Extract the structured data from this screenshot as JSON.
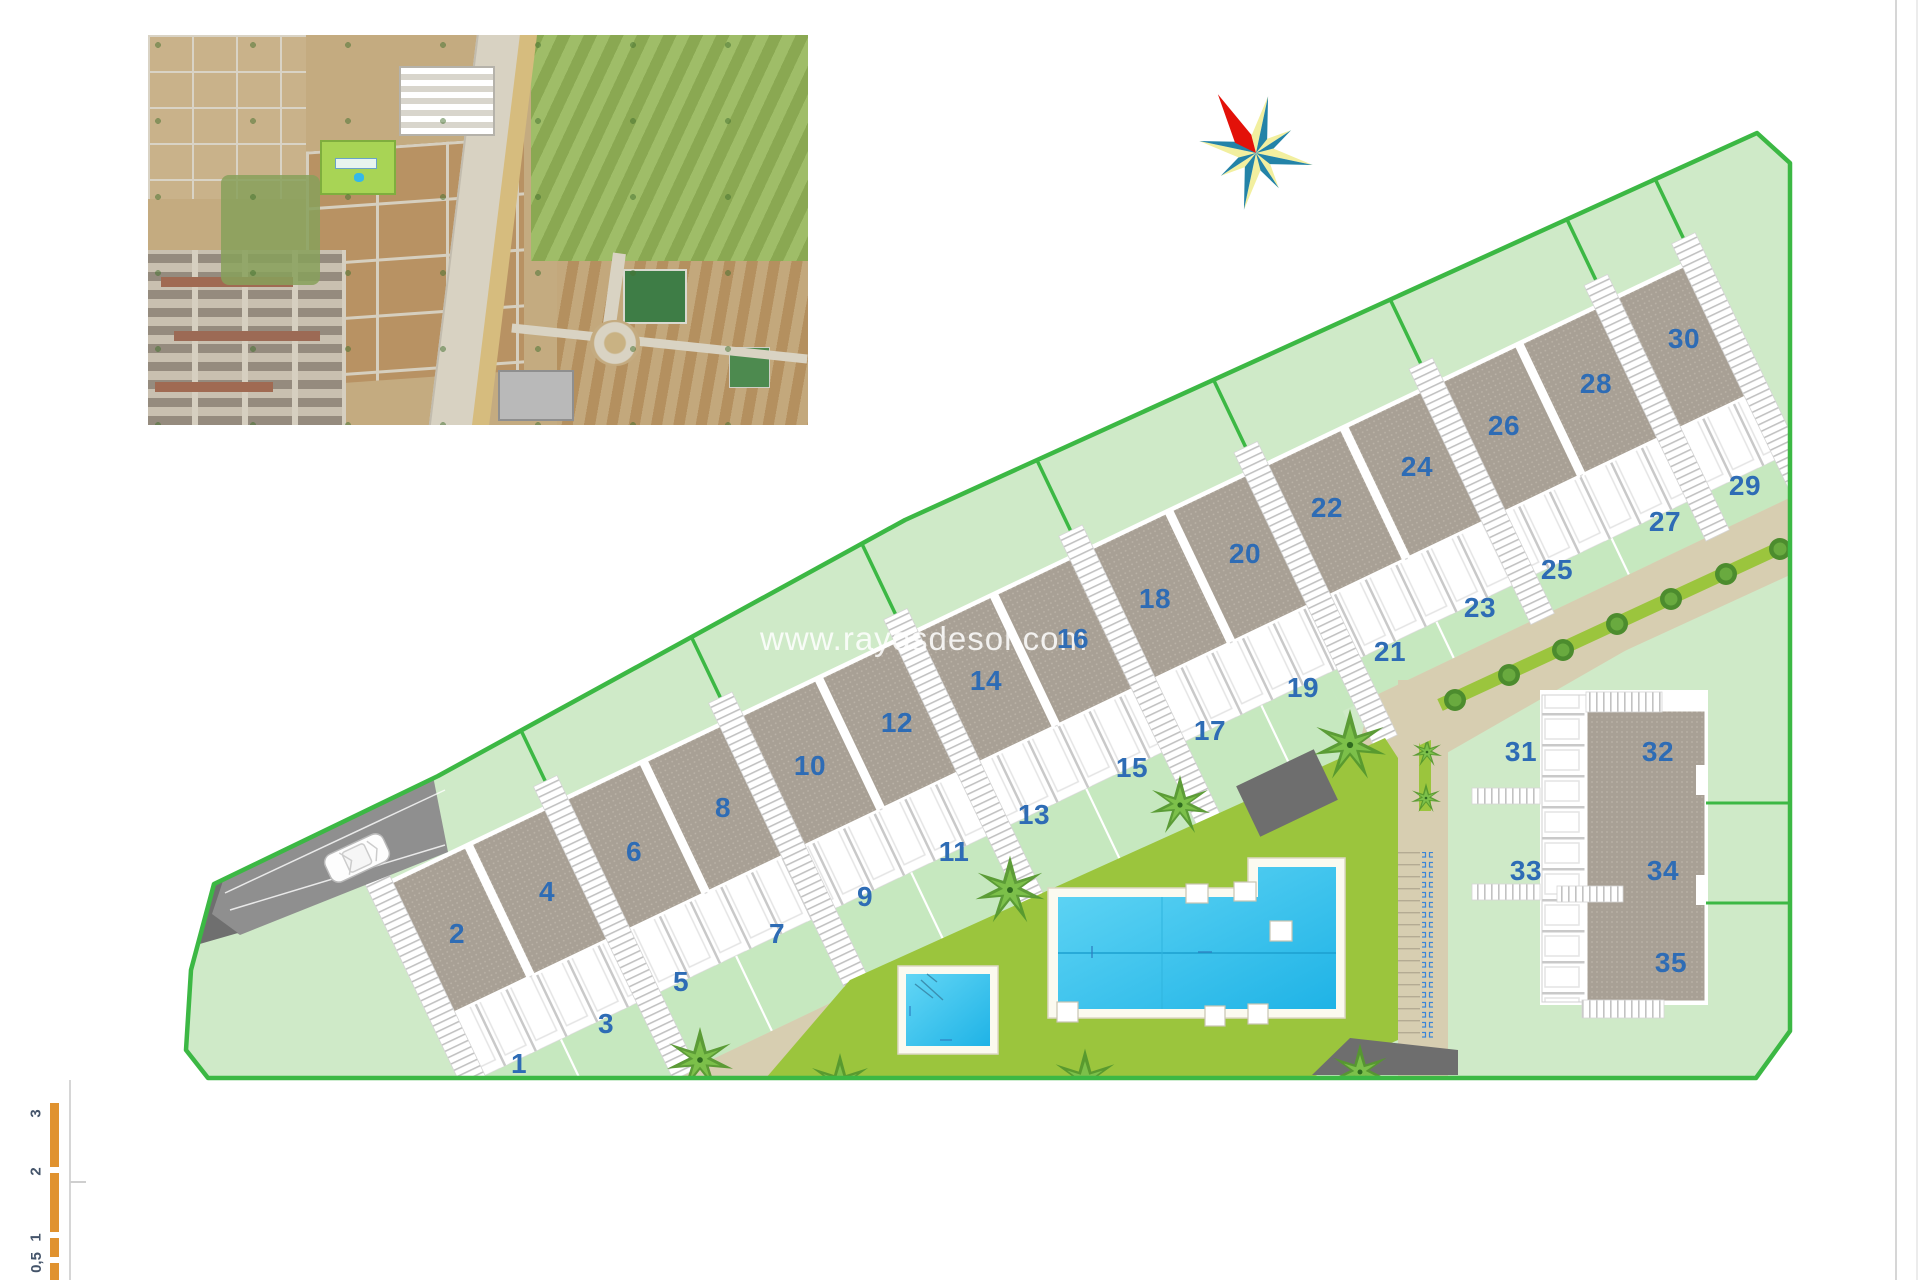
{
  "watermark": {
    "text": "www.rayosdesol.com"
  },
  "plots": {
    "labels": [
      "1",
      "2",
      "3",
      "4",
      "5",
      "6",
      "7",
      "8",
      "9",
      "10",
      "11",
      "12",
      "13",
      "14",
      "15",
      "16",
      "17",
      "18",
      "19",
      "20",
      "21",
      "22",
      "23",
      "24",
      "25",
      "26",
      "27",
      "28",
      "29",
      "30",
      "31",
      "32",
      "33",
      "34",
      "35"
    ]
  },
  "scale_bar": {
    "labels": [
      "3",
      "2",
      "1",
      "0,5"
    ]
  },
  "icons": {
    "compass": "compass-rose",
    "car": "car-top-view",
    "palm": "palm-tree",
    "street_tree": "street-tree"
  },
  "colors": {
    "parcel_green": "#cfeac8",
    "boundary_green": "#3cb844",
    "lawn_olive": "#9bc53d",
    "road_beige": "#d7ceb1",
    "roof_gray": "#a8a095",
    "pool_cyan": "#35c4ef",
    "plot_number_blue": "#2e6cb5",
    "driveway_gray": "#8f8f8f",
    "scale_bar_orange": "#e0922f",
    "compass_red": "#e31109",
    "compass_teal": "#2383a8",
    "compass_yellow": "#f2ef9f"
  }
}
